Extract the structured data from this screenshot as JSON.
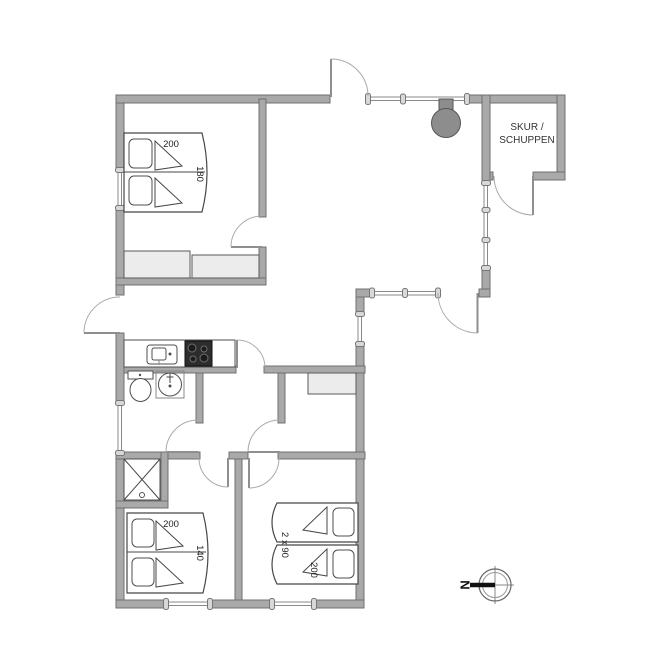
{
  "plan": {
    "shed": {
      "label_line1": "SKUR /",
      "label_line2": "SCHUPPEN"
    },
    "compass": {
      "north": "N"
    },
    "beds": {
      "master": {
        "width": "200",
        "length": "180"
      },
      "bedroom2": {
        "width": "200",
        "length": "140"
      },
      "bedroom3": {
        "count": "2 x 90",
        "length": "200"
      }
    },
    "fixtures": [
      "double-bed",
      "single-beds",
      "wardrobe",
      "kitchen-counter",
      "kitchen-sink",
      "cooktop",
      "toilet",
      "washbasin",
      "shower",
      "wood-stove",
      "compass-rose"
    ],
    "colors": {
      "background": "#ffffff",
      "wall": "#a9a9a9",
      "wall_edge": "#707070",
      "fixture_fill": "#ececec",
      "cooktop": "#2d2d2d",
      "stove_iron": "#8d8d8d",
      "text": "#222222"
    }
  }
}
